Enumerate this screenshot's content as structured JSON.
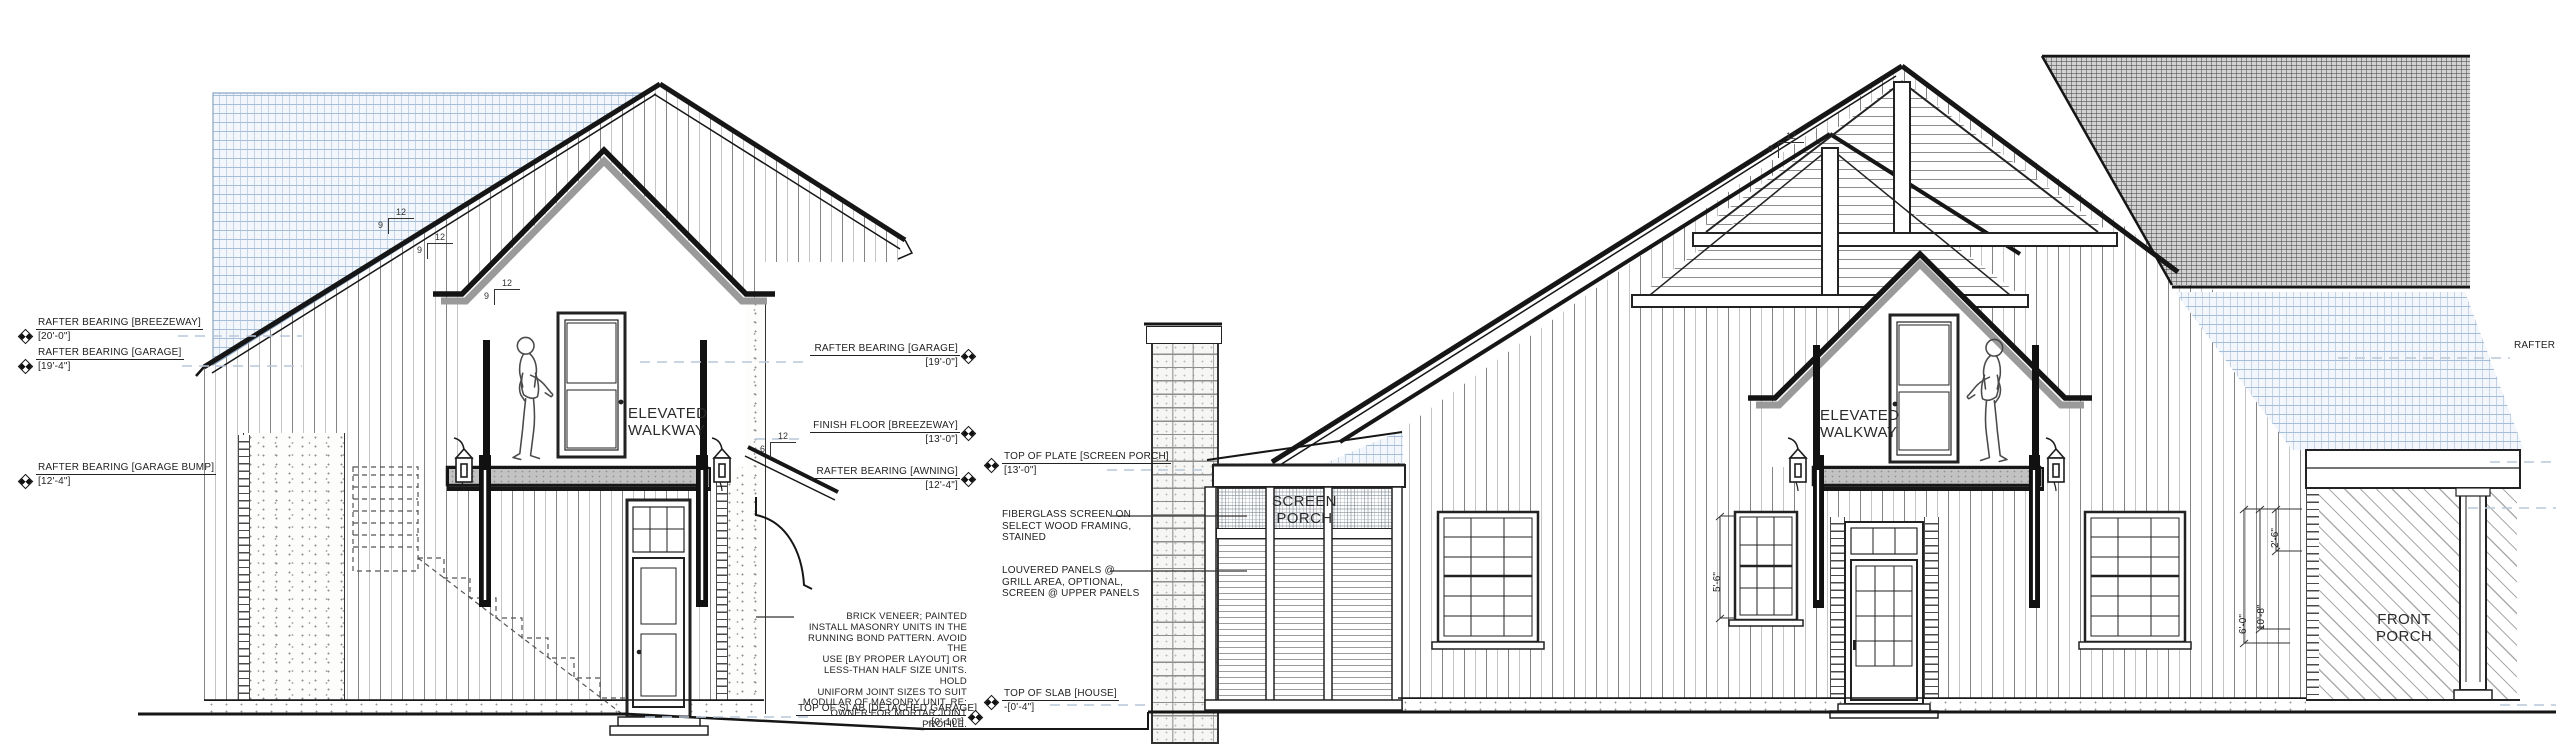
{
  "labels": {
    "elevated_walkway": "ELEVATED\nWALKWAY",
    "screen_porch": "SCREEN\nPORCH",
    "front_porch": "FRONT\nPORCH"
  },
  "left_markers": [
    {
      "label": "RAFTER BEARING [BREEZEWAY]",
      "value": "[20'-0\"]"
    },
    {
      "label": "RAFTER BEARING [GARAGE]",
      "value": "[19'-4\"]"
    },
    {
      "label": "RAFTER BEARING [GARAGE BUMP]",
      "value": "[12'-4\"]"
    }
  ],
  "mid_markers": {
    "rafter_garage": {
      "label": "RAFTER BEARING [GARAGE]",
      "value": "[19'-0\"]"
    },
    "finish_floor": {
      "label": "FINISH FLOOR [BREEZEWAY]",
      "value": "[13'-0\"]"
    },
    "rafter_awning": {
      "label": "RAFTER BEARING [AWNING]",
      "value": "[12'-4\"]"
    },
    "top_plate_screen_porch": {
      "label": "TOP OF PLATE [SCREEN PORCH]",
      "value": "[13'-0\"]"
    },
    "slab_house": {
      "label": "TOP OF SLAB [HOUSE]",
      "value": "-[0'-4\"]"
    },
    "slab_detached_garage": {
      "label": "TOP OF SLAB [DETACHED GARAGE]",
      "value": "-[0'-10\"]"
    }
  },
  "notes": {
    "brick": "BRICK VENEER; PAINTED\nINSTALL MASONRY UNITS IN THE\nRUNNING BOND PATTERN. AVOID THE\nUSE [BY PROPER LAYOUT] OR\nLESS-THAN HALF SIZE UNITS. HOLD\nUNIFORM JOINT SIZES TO SUIT\nMODULAR OF MASONRY UNIT. RE:\nOWNER FOR MORTAR JOINT PROFILE.",
    "fiberglass": "FIBERGLASS SCREEN ON\nSELECT WOOD FRAMING,\nSTAINED",
    "louvered": "LOUVERED PANELS @\nGRILL AREA, OPTIONAL,\nSCREEN @ UPPER PANELS",
    "rafter_cut": "RAFTER"
  },
  "dimensions": {
    "window": "5'-6\"",
    "d1": "2'-6\"",
    "d2": "6'-0\"",
    "d3": "10'-8\""
  },
  "slopes": {
    "run": "12",
    "rise_main": "9",
    "rise_awning": "6"
  }
}
